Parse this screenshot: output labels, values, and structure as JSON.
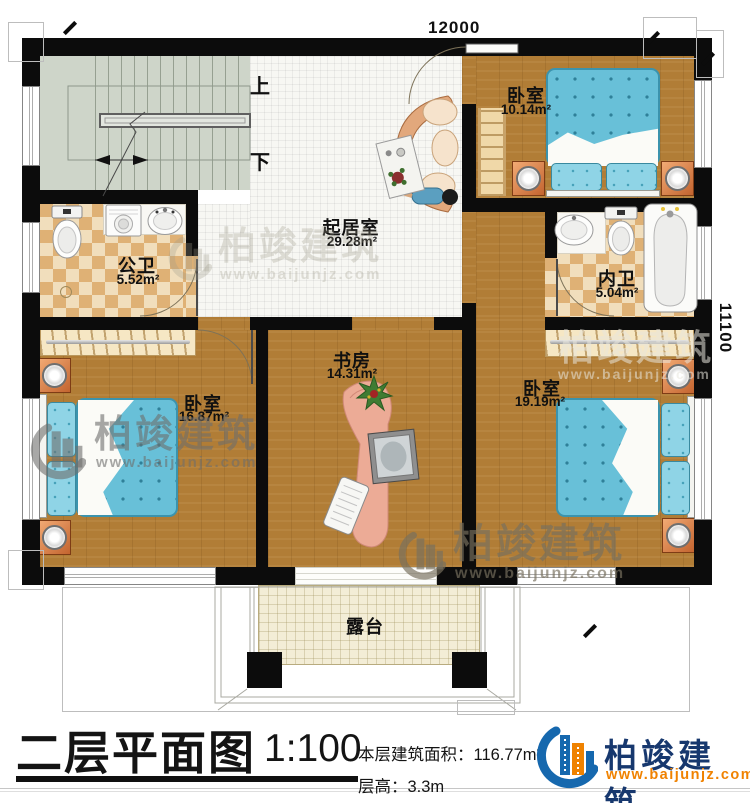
{
  "plan": {
    "dimension_top": "12000",
    "dimension_right": "11100",
    "stair_up_label": "上",
    "stair_down_label": "下",
    "rooms": {
      "bedroom_top_right": {
        "name": "卧室",
        "area": "10.14m²"
      },
      "public_bathroom": {
        "name": "公卫",
        "area": "5.52m²"
      },
      "living_room": {
        "name": "起居室",
        "area": "29.28m²"
      },
      "private_bathroom": {
        "name": "内卫",
        "area": "5.04m²"
      },
      "study": {
        "name": "书房",
        "area": "14.31m²"
      },
      "bedroom_bottom_left": {
        "name": "卧室",
        "area": "16.87m²"
      },
      "bedroom_bottom_right": {
        "name": "卧室",
        "area": "19.19m²"
      },
      "terrace": {
        "name": "露台"
      }
    }
  },
  "watermark": {
    "brand": "柏竣建筑",
    "url": "www.baijunjz.com"
  },
  "title_block": {
    "title": "二层平面图",
    "scale": "1:100",
    "area_label": "本层建筑面积：",
    "area_value": "116.77m²",
    "floor_height_label": "层高：",
    "floor_height_value": "3.3m",
    "brand": "柏竣建筑",
    "brand_url": "www.baijunjz.com"
  },
  "colors": {
    "wall": "#0c0c0c",
    "wood_floor": "#b17d36",
    "tile_floor": "#f7f7f3",
    "checker_tile": "#dfb175",
    "stair_floor": "#ced5c9",
    "terrace_floor": "#f3edd6",
    "bed_blue": "#68c0d8",
    "brand_blue": "#1668ae",
    "brand_orange": "#f08200",
    "brand_text": "#17386e"
  }
}
